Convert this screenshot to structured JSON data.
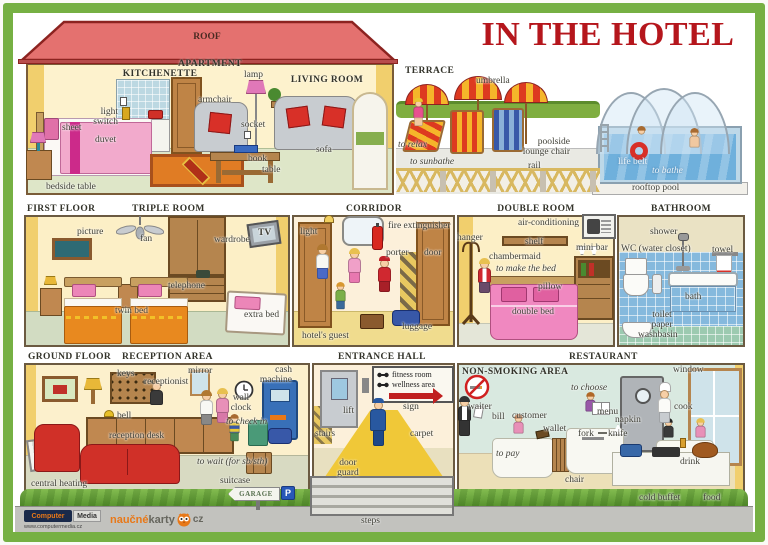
{
  "title": "IN THE HOTEL",
  "colors": {
    "frame_green": "#76b043",
    "title_red": "#b5161c",
    "roof_red": "#e4716f",
    "wall_yellow": "#f1cf6d",
    "accent_red": "#d03028"
  },
  "apartment": {
    "roof_label": "ROOF",
    "header": "APARTMENT",
    "kitchenette_header": "KITCHENETTE",
    "living_room_header": "LIVING ROOM",
    "labels": {
      "light_switch": "light switch",
      "sheet": "sheet",
      "duvet": "duvet",
      "bedside_table": "bedside table",
      "lamp": "lamp",
      "armchair": "armchair",
      "socket": "socket",
      "book": "book",
      "table": "table",
      "sofa": "sofa"
    }
  },
  "terrace": {
    "header": "TERRACE",
    "labels": {
      "umbrella": "umbrella",
      "to_relax": "to relax",
      "to_sunbathe": "to sunbathe",
      "poolside_lounge_chair": "poolside lounge chair",
      "rail": "rail"
    }
  },
  "pool": {
    "labels": {
      "life_belt": "life belt",
      "to_bathe": "to bathe",
      "rooftop_pool": "rooftop pool"
    }
  },
  "first_floor": {
    "header": "FIRST FLOOR",
    "triple_room": {
      "header": "TRIPLE ROOM",
      "labels": {
        "picture": "picture",
        "fan": "fan",
        "wardrobe": "wardrobe",
        "tv": "TV",
        "telephone": "telephone",
        "twin_bed": "twin bed",
        "extra_bed": "extra bed"
      }
    },
    "corridor": {
      "header": "CORRIDOR",
      "labels": {
        "light": "light",
        "fire_extinguisher": "fire extinguisher",
        "porter": "porter",
        "door": "door",
        "luggage": "luggage",
        "hotels_guest": "hotel's guest"
      }
    },
    "double_room": {
      "header": "DOUBLE ROOM",
      "labels": {
        "hanger": "hanger",
        "air_conditioning": "air-conditioning",
        "shelf": "shelf",
        "mini_bar": "mini bar",
        "chambermaid": "chambermaid",
        "to_make_the_bed": "to make the bed",
        "pillow": "pillow",
        "double_bed": "double bed"
      }
    },
    "bathroom": {
      "header": "BATHROOM",
      "labels": {
        "shower": "shower",
        "wc": "WC (water closet)",
        "towel": "towel",
        "bath": "bath",
        "toilet_paper": "toilet paper",
        "washbasin": "washbasin"
      }
    }
  },
  "ground_floor": {
    "header": "GROUND FLOOR",
    "reception": {
      "header": "RECEPTION AREA",
      "labels": {
        "keys": "keys",
        "receptionist": "receptionist",
        "mirror": "mirror",
        "cash_machine": "cash machine",
        "wall_clock": "wall clock",
        "bell": "bell",
        "to_check_in": "to check in",
        "reception_desk": "reception desk",
        "central_heating": "central heating",
        "to_wait": "to wait (for sb/sth)",
        "suitcase": "suitcase",
        "garage": "GARAGE",
        "parking": "P"
      }
    },
    "entrance_hall": {
      "header": "ENTRANCE HALL",
      "labels": {
        "lift": "lift",
        "fitness_room": "fitness room",
        "wellness_area": "wellness area",
        "sign": "sign",
        "stairs": "stairs",
        "carpet": "carpet",
        "door_guard": "door guard",
        "steps": "steps"
      }
    },
    "restaurant": {
      "header": "RESTAURANT",
      "non_smoking_header": "NON-SMOKING AREA",
      "labels": {
        "to_choose": "to choose",
        "window": "window",
        "waiter": "waiter",
        "bill": "bill",
        "customer": "customer",
        "wallet": "wallet",
        "menu": "menu",
        "napkin": "napkin",
        "cook": "cook",
        "fork": "fork",
        "knife": "knife",
        "to_pay": "to pay",
        "chair": "chair",
        "drink": "drink",
        "cold_buffet": "cold buffet",
        "food": "food"
      }
    }
  },
  "footer": {
    "brand_computer": "Computer",
    "brand_media": "Media",
    "brand_url": "www.computermedia.cz",
    "brand_naucne": "naučné",
    "brand_karty": "karty",
    "brand_tld": "cz"
  }
}
